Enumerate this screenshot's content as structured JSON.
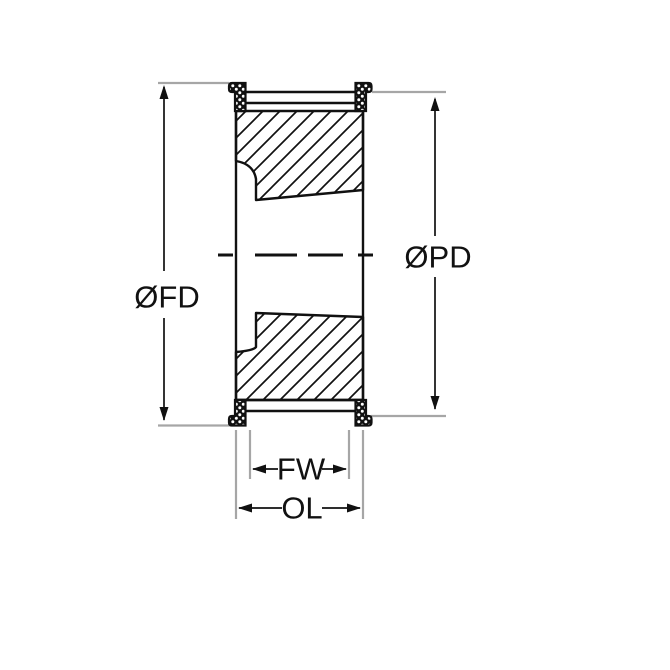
{
  "drawing": {
    "title": "timing-pulley-cross-section",
    "labels": {
      "flange_diameter": "ØFD",
      "pitch_diameter": "ØPD",
      "face_width": "FW",
      "overall_length": "OL"
    },
    "colors": {
      "line": "#111111",
      "extension_line": "#a6a6a6",
      "background": "#ffffff"
    }
  }
}
